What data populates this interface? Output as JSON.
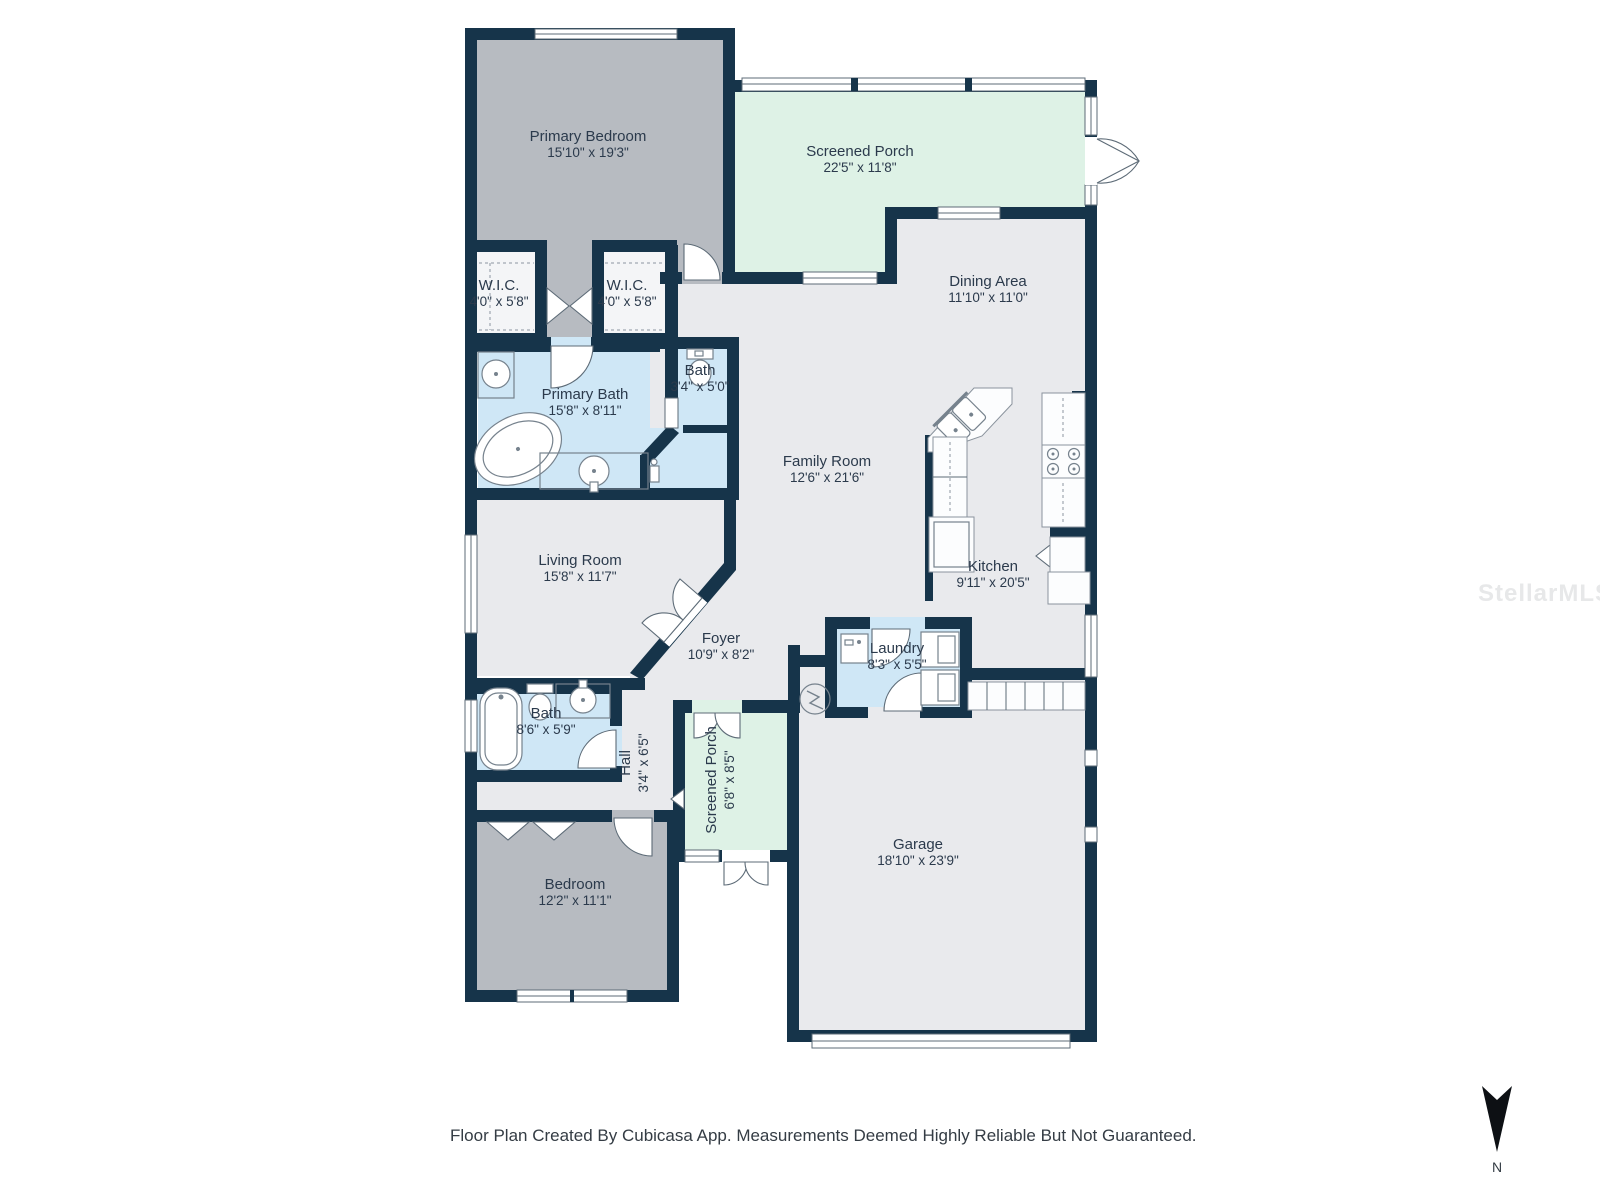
{
  "rooms": {
    "primary_bedroom": {
      "name": "Primary Bedroom",
      "dims": "15'10\" x 19'3\""
    },
    "screened_porch_top": {
      "name": "Screened Porch",
      "dims": "22'5\" x 11'8\""
    },
    "wic_left": {
      "name": "W.I.C.",
      "dims": "4'0\" x 5'8\""
    },
    "wic_right": {
      "name": "W.I.C.",
      "dims": "4'0\" x 5'8\""
    },
    "dining_area": {
      "name": "Dining Area",
      "dims": "11'10\" x 11'0\""
    },
    "primary_bath": {
      "name": "Primary Bath",
      "dims": "15'8\" x 8'11\""
    },
    "water_closet": {
      "name": "Bath",
      "dims": "3'4\" x 5'0\""
    },
    "family_room": {
      "name": "Family Room",
      "dims": "12'6\" x 21'6\""
    },
    "living_room": {
      "name": "Living Room",
      "dims": "15'8\" x 11'7\""
    },
    "kitchen": {
      "name": "Kitchen",
      "dims": "9'11\" x 20'5\""
    },
    "foyer": {
      "name": "Foyer",
      "dims": "10'9\" x 8'2\""
    },
    "laundry": {
      "name": "Laundry",
      "dims": "8'3\" x 5'5\""
    },
    "hall_bath": {
      "name": "Bath",
      "dims": "8'6\" x 5'9\""
    },
    "hall": {
      "name": "Hall",
      "dims": "3'4\" x 6'5\""
    },
    "screened_porch_small": {
      "name": "Screened Porch",
      "dims": "6'8\" x 8'5\""
    },
    "bedroom2": {
      "name": "Bedroom",
      "dims": "12'2\" x 11'1\""
    },
    "garage": {
      "name": "Garage",
      "dims": "18'10\" x 23'9\""
    }
  },
  "footer": {
    "disclaimer": "Floor Plan Created By Cubicasa App. Measurements Deemed Highly Reliable But Not Guaranteed."
  },
  "compass": {
    "label": "N"
  },
  "watermark": {
    "text": "StellarMLS"
  },
  "colors": {
    "wall": "#16344a",
    "floor": "#e9eaed",
    "bedroom_floor": "#b7bbc1",
    "bath_floor": "#cfe7f6",
    "porch_floor": "#def2e6",
    "background": "#ffffff"
  }
}
